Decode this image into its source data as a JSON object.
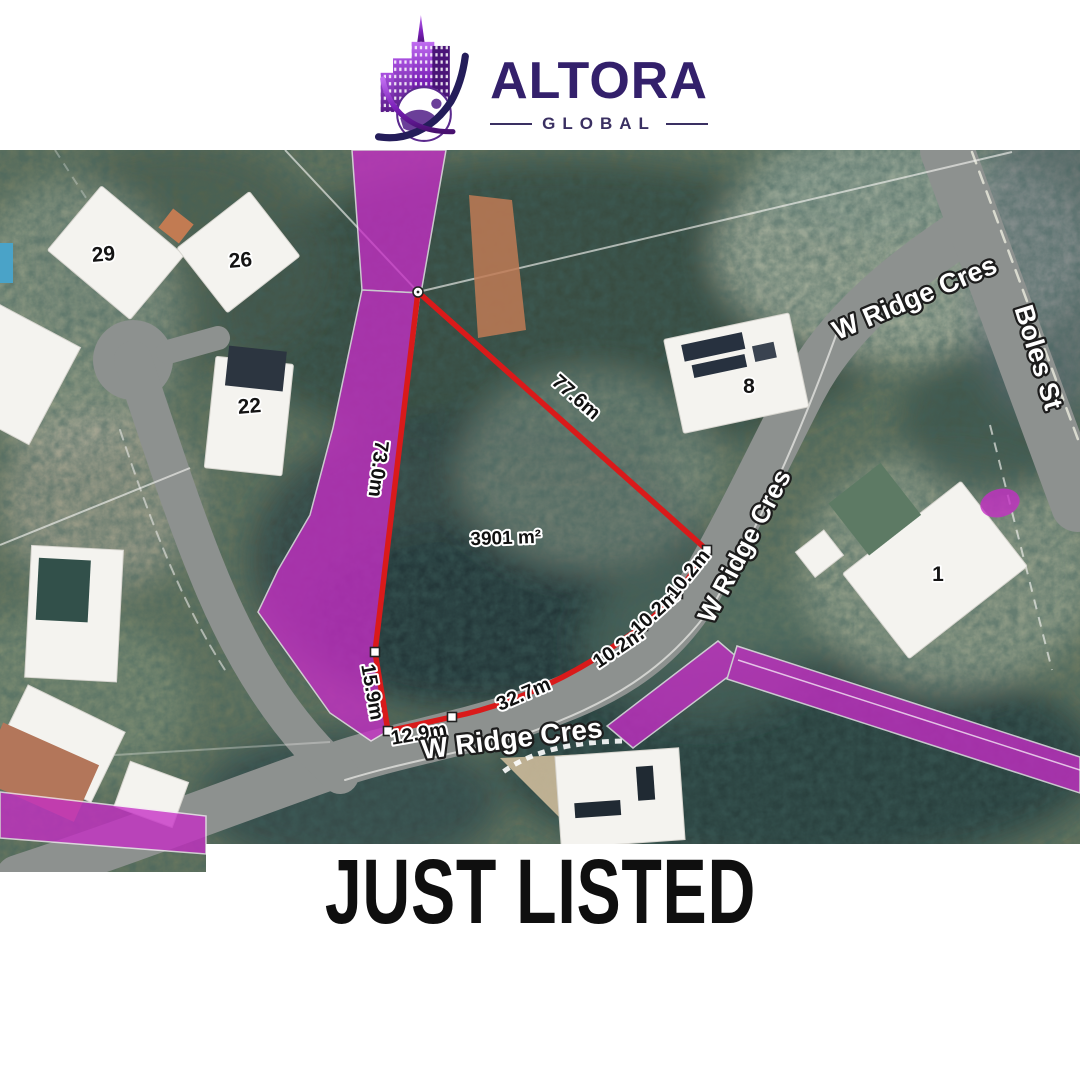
{
  "brand": {
    "name": "ALTORA",
    "subtitle": "GLOBAL"
  },
  "banner": {
    "title": "JUST LISTED"
  },
  "map": {
    "area_label": "3901 m²",
    "dimensions": {
      "west": "73.0m",
      "northeast": "77.6m",
      "southwest_1": "15.9m",
      "southwest_2": "12.9m",
      "south": "32.7m",
      "southeast_1": "10.2m",
      "southeast_2": "10.2m",
      "southeast_3": "10.2m"
    },
    "streets": {
      "w_ridge_cres_top": "W Ridge Cres",
      "w_ridge_cres_mid": "W Ridge Cres",
      "w_ridge_cres_bottom": "W Ridge Cres",
      "boles_st": "Boles St"
    },
    "house_numbers": {
      "n29": "29",
      "n26": "26",
      "n22": "22",
      "n8": "8",
      "n1": "1"
    },
    "colors": {
      "boundary": "#d91a1a",
      "highlight": "#c62ec6"
    }
  }
}
